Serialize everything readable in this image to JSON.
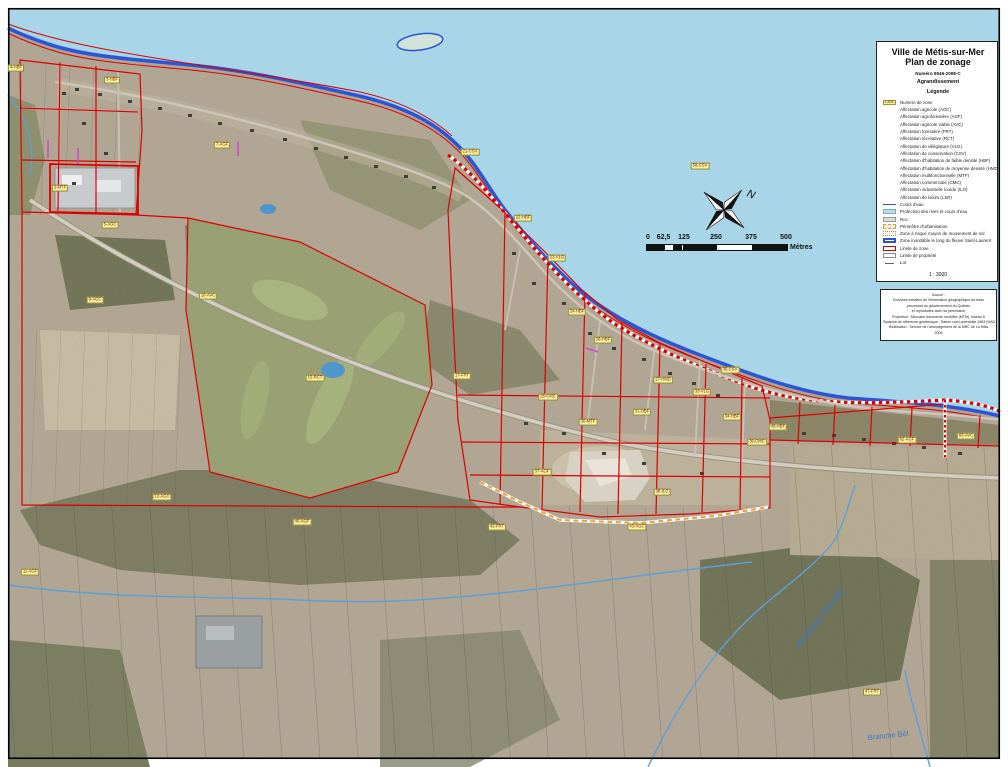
{
  "title_block": {
    "line1": "Ville de Métis-sur-Mer",
    "line2": "Plan de zonage",
    "number": "Numéro 9546-2008-C",
    "subtitle1": "Agrandissement",
    "subtitle2": "Légende"
  },
  "legend": {
    "zone_sample_label": "1-AGC",
    "zone_sample_text": "Numéro de zone",
    "affectations": [
      "Affectation agricole (AGC)",
      "Affectation agroforestière (AGF)",
      "Affectation agricole viable (AVC)",
      "Affectation forestière (FRT)",
      "Affectation récréative (RCT)",
      "Affectation de villégiature (VLG)",
      "Affectation de conservation (CSV)",
      "Affectation d'habitation de faible densité (HBF)",
      "Affectation d'habitation de moyenne densité (HMD)",
      "Affectation multifonctionnelle (MTF)",
      "Affectation commerciale (CMC)",
      "Affectation industrielle lourde (ILO)",
      "Affectation de loisirs (LSR)"
    ],
    "symbols": [
      {
        "label": "Cours d'eau"
      },
      {
        "label": "Protection des rives et cours d'eau"
      },
      {
        "label": "Roc"
      },
      {
        "label": "Périmètre d'urbanisation"
      },
      {
        "label": "Zone à risque moyen de mouvement de sol"
      },
      {
        "label": "Zone inondable le long du fleuve Saint-Laurent"
      },
      {
        "label": "Limite de zone"
      },
      {
        "label": "Limite de propriété"
      },
      {
        "label": "Lot"
      }
    ],
    "scale_text": "1 : 3000"
  },
  "sources": {
    "lines": [
      "Source :",
      "Données extraites de l'information géographique de base",
      "provenant du gouvernement du Québec",
      "et reproduites avec sa permission",
      "Projection : Mercator transverse modifiée (MTM), fuseau 6",
      "Système de référence géodésique : Datum nord-américain 1983 (NAD 83)",
      "Réalisation : Service de l'aménagement de la MRC de La Mitis",
      "2008"
    ]
  },
  "scalebar": {
    "ticks": [
      "0",
      "62,5",
      "125",
      "250",
      "375",
      "500"
    ],
    "unit": "Mètres"
  },
  "north": {
    "label": "N"
  },
  "map": {
    "colors": {
      "water": "#a8d6e8",
      "shoreline": "#2b55d4",
      "zone_limit": "#dd0000",
      "urban_perimeter_dash": "#e8a23c",
      "zone_label_bg": "#f8f29e",
      "land_base": "#b2a794"
    },
    "stream_labels": [
      {
        "label": "Ruisseau Plourde"
      },
      {
        "label": "Branche Bél"
      }
    ],
    "zone_labels": [
      {
        "x": 16,
        "y": 68,
        "label": "4-HBF"
      },
      {
        "x": 112,
        "y": 80,
        "label": "3-HBF"
      },
      {
        "x": 60,
        "y": 188,
        "label": "2-MTF"
      },
      {
        "x": 110,
        "y": 225,
        "label": "5-AGC"
      },
      {
        "x": 222,
        "y": 145,
        "label": "7-AGF"
      },
      {
        "x": 95,
        "y": 300,
        "label": "9-AGC"
      },
      {
        "x": 208,
        "y": 296,
        "label": "10-AVC"
      },
      {
        "x": 315,
        "y": 378,
        "label": "15-RCT"
      },
      {
        "x": 462,
        "y": 376,
        "label": "17-FRT"
      },
      {
        "x": 470,
        "y": 152,
        "label": "21-CSV"
      },
      {
        "x": 523,
        "y": 218,
        "label": "22-HBF"
      },
      {
        "x": 557,
        "y": 258,
        "label": "23-VLG"
      },
      {
        "x": 577,
        "y": 312,
        "label": "24-HBF"
      },
      {
        "x": 603,
        "y": 340,
        "label": "26-HBF"
      },
      {
        "x": 548,
        "y": 397,
        "label": "28-CMC"
      },
      {
        "x": 588,
        "y": 422,
        "label": "30-MTF"
      },
      {
        "x": 642,
        "y": 412,
        "label": "31-HBF"
      },
      {
        "x": 663,
        "y": 380,
        "label": "27-HMD"
      },
      {
        "x": 702,
        "y": 392,
        "label": "33-VLG"
      },
      {
        "x": 732,
        "y": 417,
        "label": "34-HBF"
      },
      {
        "x": 757,
        "y": 442,
        "label": "36-CMC"
      },
      {
        "x": 662,
        "y": 492,
        "label": "38-ILO"
      },
      {
        "x": 542,
        "y": 472,
        "label": "37-AGF"
      },
      {
        "x": 700,
        "y": 166,
        "label": "58-CSV"
      },
      {
        "x": 730,
        "y": 370,
        "label": "35-CSV"
      },
      {
        "x": 778,
        "y": 427,
        "label": "45-HBF"
      },
      {
        "x": 907,
        "y": 440,
        "label": "62-AGF"
      },
      {
        "x": 966,
        "y": 436,
        "label": "63-AVC"
      },
      {
        "x": 30,
        "y": 572,
        "label": "11-AGF"
      },
      {
        "x": 162,
        "y": 497,
        "label": "12-AGC"
      },
      {
        "x": 302,
        "y": 522,
        "label": "40-AGF"
      },
      {
        "x": 497,
        "y": 527,
        "label": "41-FRT"
      },
      {
        "x": 637,
        "y": 527,
        "label": "43-AGC"
      },
      {
        "x": 872,
        "y": 692,
        "label": "47-FRT"
      }
    ]
  }
}
